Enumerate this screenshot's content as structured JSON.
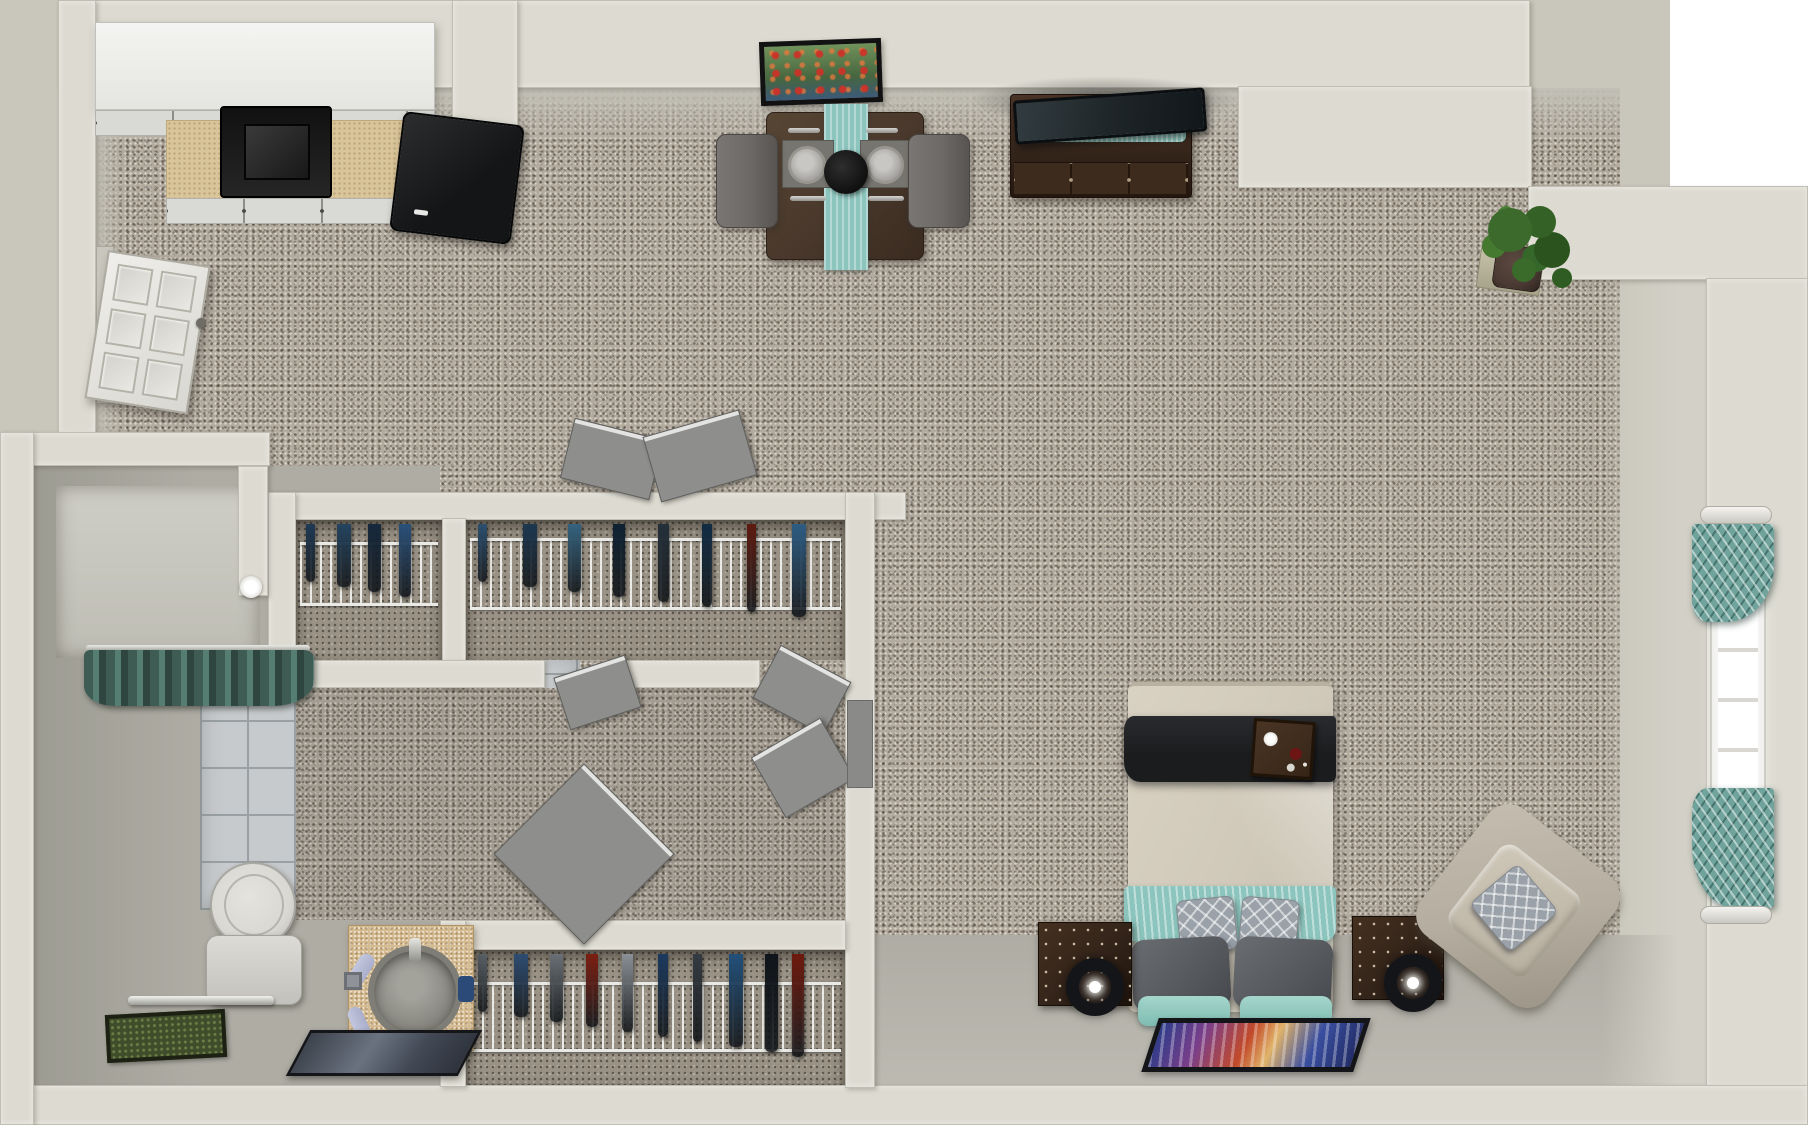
{
  "scene": {
    "title": "One-bedroom apartment floor plan — top-down 3D render",
    "view": "overhead dollhouse view",
    "visible_text": "none"
  },
  "colors": {
    "canvas": "#ffffff",
    "exterior": "#c9c6bb",
    "wall": "#dddbd1",
    "wallShade": "#c2c0b6",
    "carpet": "#b3ab9e",
    "carpetDark": "#9a9285",
    "smooth": "#aeaca3",
    "tile": "#c7cacc",
    "grout": "#9aa0a3",
    "teal": "#8cc5bd",
    "tealDark": "#43625a",
    "tealCurtain": "#6fa39b",
    "woodDark": "#33241a",
    "woodMid": "#4a392c",
    "black": "#1b1c1e",
    "white": "#efeeea",
    "counterTan": "#d9c59a",
    "vanityTan": "#d5bc92",
    "chairGray": "#6d6967",
    "pillowGray": "#55585c",
    "pillowLight": "#9aa1a9",
    "armchairBeige": "#b5ad9f",
    "bedBeige": "#d0c9b9",
    "lampBlack": "#141518",
    "rugGreen": "#3f4d2b",
    "doorGray": "#8e8e8c",
    "sinkGray": "#8d8c85",
    "toiletWhite": "#d9d8d2",
    "towelLavender": "#a9aecb",
    "plantGreen": "#3c6a2c",
    "potBrown": "#4a3a33"
  },
  "rooms": [
    {
      "name": "kitchen"
    },
    {
      "name": "living-dining area"
    },
    {
      "name": "hallway"
    },
    {
      "name": "bathroom"
    },
    {
      "name": "closets"
    },
    {
      "name": "sleeping area"
    }
  ],
  "closets": {
    "upper_small": {
      "label": "small closet",
      "clothes": [
        "#1f3a55",
        "#24445f",
        "#16293d",
        "#2b517a"
      ]
    },
    "upper_large": {
      "label": "walk-in closet",
      "clothes": [
        "#2b4f6e",
        "#1d3850",
        "#35637f",
        "#0f2233",
        "#24303a",
        "#122c44",
        "#5e1b10",
        "#2e5d83"
      ]
    },
    "lower": {
      "label": "second closet",
      "clothes": [
        "#596066",
        "#2e4d72",
        "#6a7076",
        "#7c1f12",
        "#8a9096",
        "#1c3a5e",
        "#343b42",
        "#23507a",
        "#10151b",
        "#6e1a0e"
      ]
    }
  },
  "furniture": [
    "white upper cabinets",
    "tan countertop with black stove",
    "black refrigerator",
    "framed poppy-flower wall art",
    "dark wood dining table with teal runner and two gray chairs",
    "place settings with plates and fruit bowl",
    "dark wood tv stand with flat-screen tv and teal runner",
    "potted green plant",
    "white six-panel entry door",
    "wire closet shelving with hanging clothes",
    "open interior doors",
    "shower with dark teal curtain and shower head",
    "white tiled bathroom floor",
    "toilet",
    "tan vanity with round sink, faucet and lavender towels",
    "angled mirror",
    "chrome towel bar",
    "dark green bath rug",
    "bed with beige comforter, black throw and breakfast tray",
    "teal blanket, gray and teal pillows, diamond-pattern accent pillows",
    "two dark wood nightstands with round black lamps",
    "colorful abstract area rug",
    "beige armchair with patterned pillow",
    "right-wall window with teal patterned curtains and white rods"
  ]
}
